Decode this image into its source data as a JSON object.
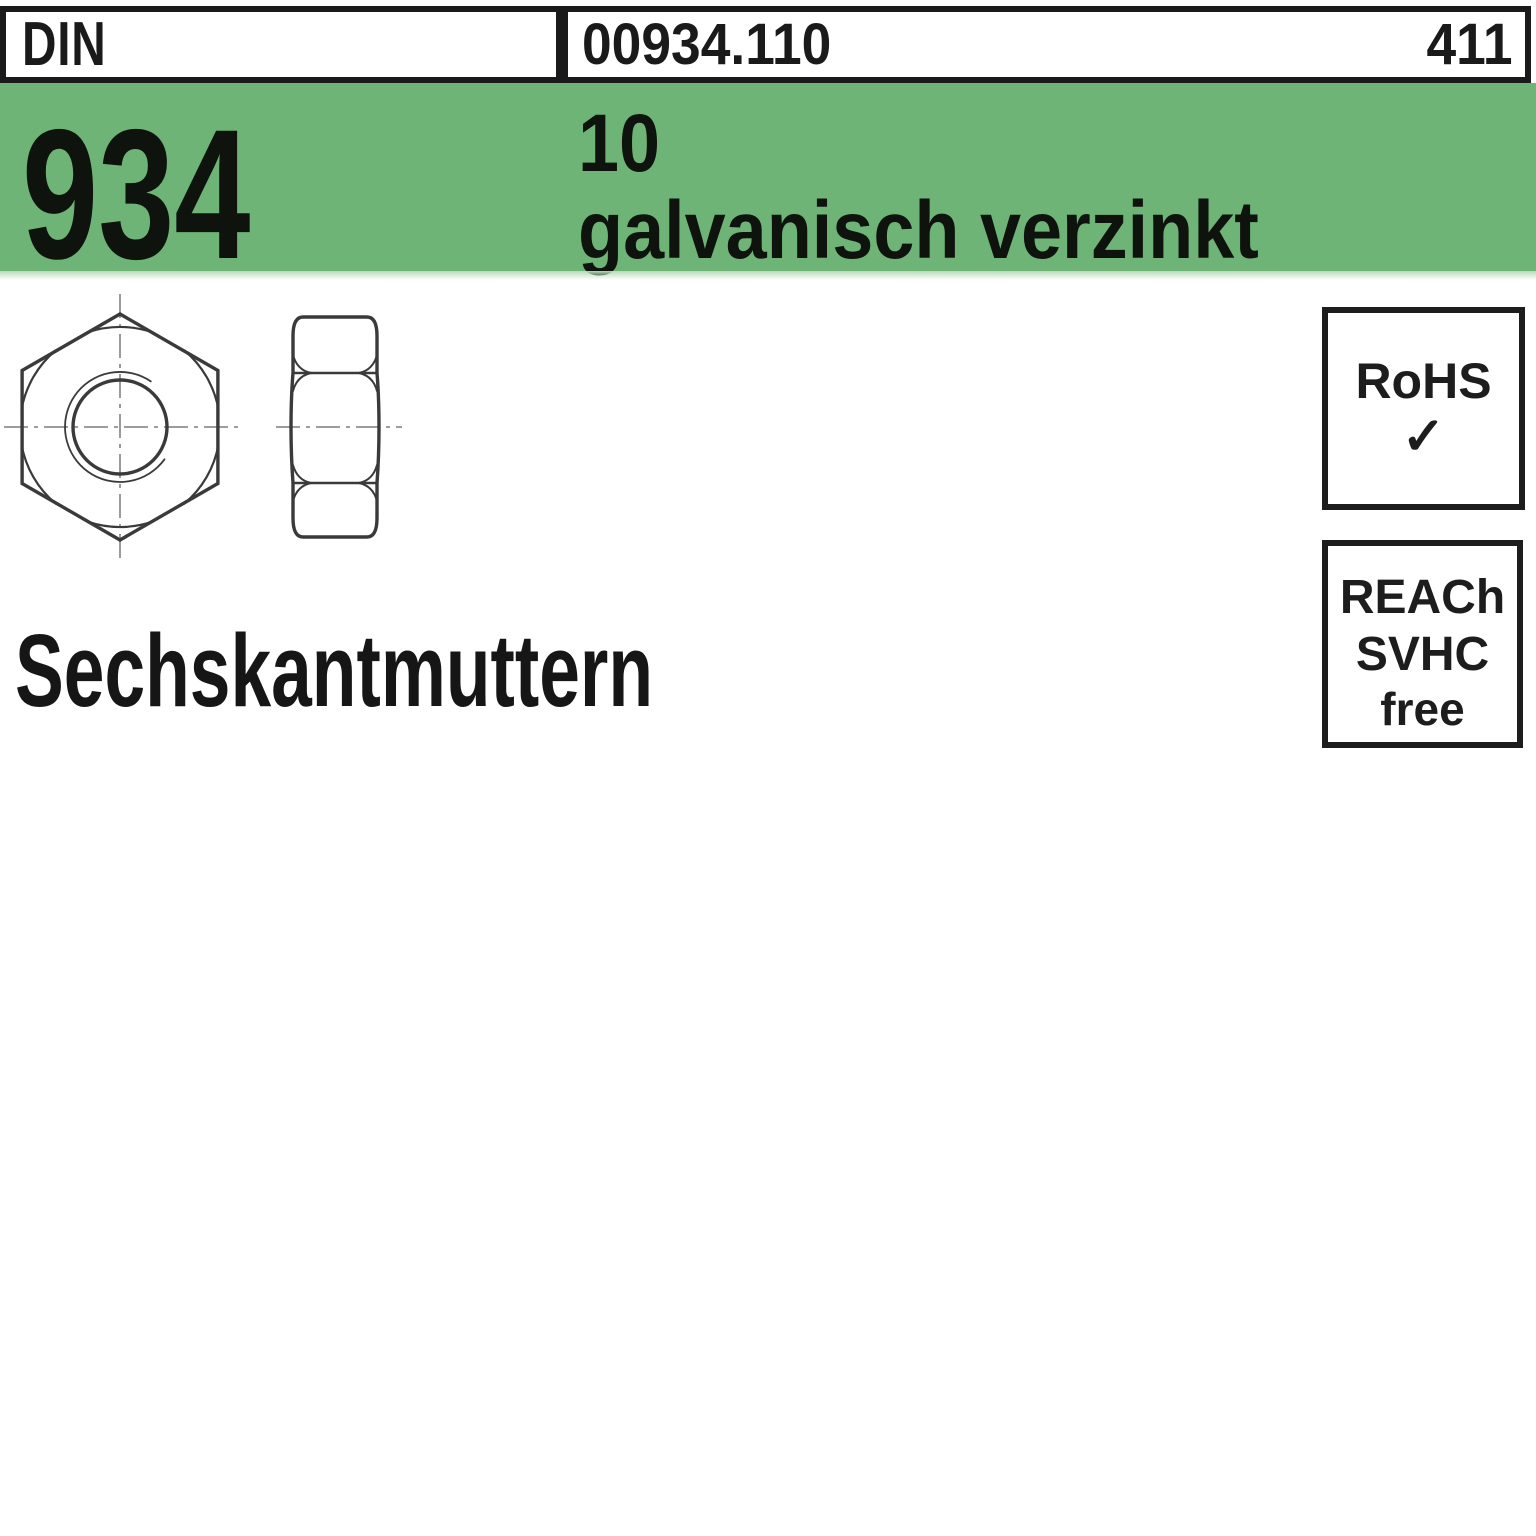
{
  "page": {
    "background_color": "#ffffff",
    "accent_green": "#6eb476",
    "border_black": "#1a1a1a"
  },
  "header": {
    "din_label": "DIN",
    "article_number": "00934.110",
    "page_number": "411"
  },
  "banner": {
    "standard_number": "934",
    "property_class": "10",
    "surface_finish": "galvanisch verzinkt"
  },
  "drawing": {
    "front_view_icon": "hex-nut-front-view",
    "side_view_icon": "hex-nut-side-view"
  },
  "title": {
    "text": "Sechskantmuttern"
  },
  "badges": {
    "rohs": {
      "label": "RoHS",
      "check_glyph": "✓"
    },
    "reach": {
      "line1": "REACh",
      "line2": "SVHC",
      "line3": "free"
    }
  }
}
